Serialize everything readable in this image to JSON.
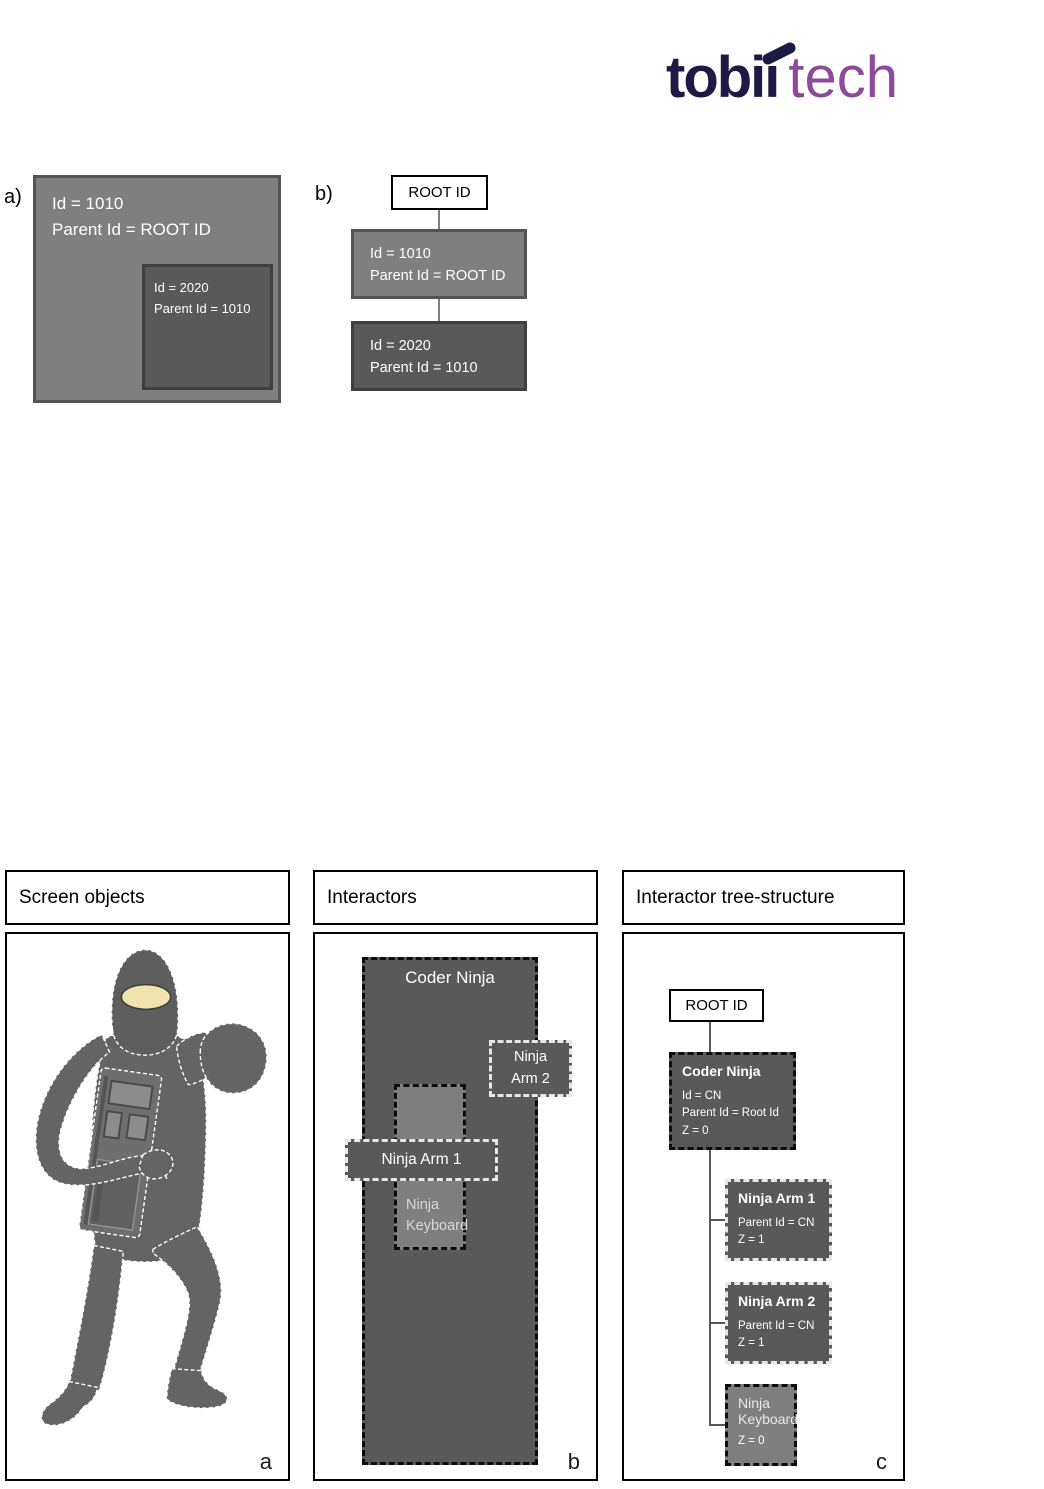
{
  "logo": {
    "brand": "tobii",
    "suffix": "tech",
    "brand_color": "#1e1a46",
    "suffix_color": "#8d4a9d"
  },
  "top_diagrams": {
    "a": {
      "label": "a)",
      "outer_box": {
        "line1": "Id = 1010",
        "line2": "Parent Id = ROOT ID"
      },
      "inner_box": {
        "line1": "Id = 2020",
        "line2": "Parent Id = 1010"
      }
    },
    "b": {
      "label": "b)",
      "root_label": "ROOT ID",
      "node1": {
        "line1": "Id = 1010",
        "line2": "Parent Id = ROOT ID"
      },
      "node2": {
        "line1": "Id = 2020",
        "line2": "Parent Id = 1010"
      }
    }
  },
  "panels": {
    "screen_objects": {
      "title": "Screen objects",
      "corner_label": "a"
    },
    "interactors": {
      "title": "Interactors",
      "corner_label": "b",
      "coder_ninja_label": "Coder Ninja",
      "ninja_arm_2": {
        "line1": "Ninja",
        "line2": "Arm 2"
      },
      "ninja_arm_1_label": "Ninja Arm 1",
      "ninja_keyboard": {
        "line1": "Ninja",
        "line2": "Keyboard"
      }
    },
    "tree_structure": {
      "title": "Interactor tree-structure",
      "corner_label": "c",
      "root_label": "ROOT ID",
      "coder_ninja": {
        "title": "Coder Ninja",
        "line1": "Id = CN",
        "line2": "Parent Id = Root Id",
        "line3": "Z = 0"
      },
      "ninja_arm_1": {
        "title": "Ninja Arm 1",
        "line1": "Parent Id = CN",
        "line2": "Z = 1"
      },
      "ninja_arm_2": {
        "title": "Ninja Arm 2",
        "line1": "Parent Id = CN",
        "line2": "Z = 1"
      },
      "ninja_keyboard": {
        "title_line1": "Ninja",
        "title_line2": "Keyboard",
        "line1": "Z = 0"
      }
    }
  },
  "colors": {
    "gray_mid": "#7f7f7f",
    "gray_dark": "#595959",
    "border_dark": "#3f3f3f",
    "ninja_body": "#646464",
    "ninja_face": "#efe3ae"
  }
}
